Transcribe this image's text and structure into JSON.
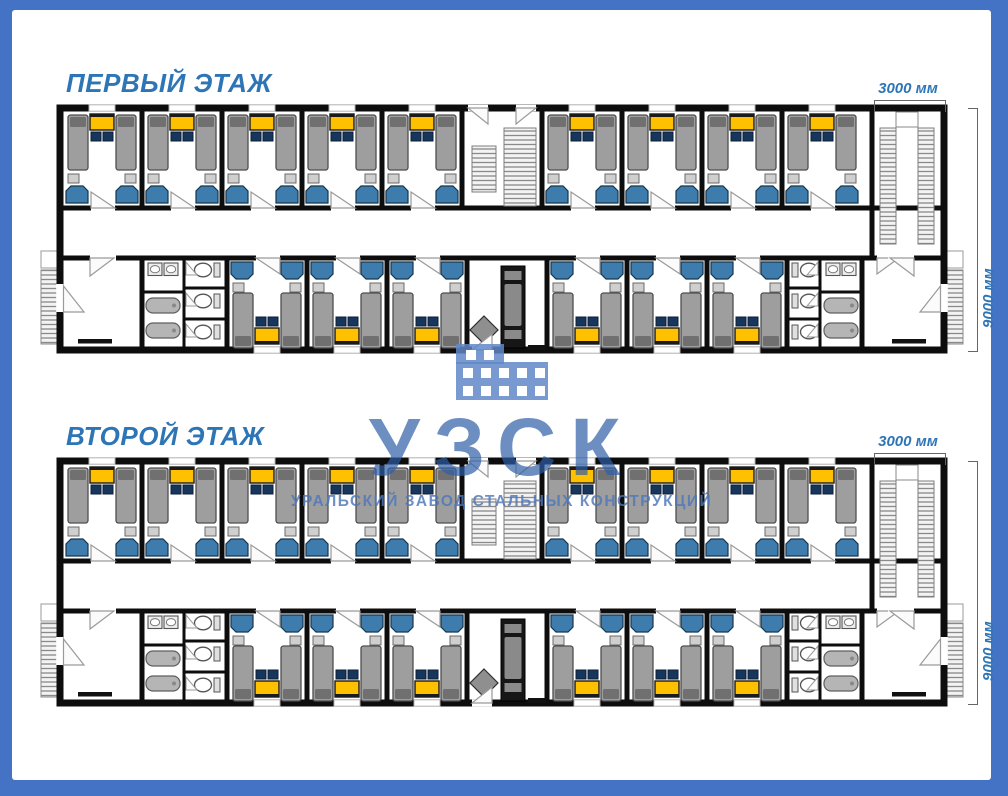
{
  "palette": {
    "frame_blue": "#4472C4",
    "title_blue": "#2E75B6",
    "wall": "#0d0d0d",
    "bed": "#9e9e9e",
    "bed_pillow": "#707070",
    "table": "#FFC000",
    "chair": "#17365D",
    "wardrobe": "#3F7CAE",
    "fixture_gray": "#b5b5b5",
    "door_gray": "#9a9a9a"
  },
  "watermark": {
    "logo_text": "УЗСК",
    "subtitle_text": "УРАЛЬСКИЙ ЗАВОД СТАЛЬНЫХ КОНСТРУКЦИЙ"
  },
  "floors": [
    {
      "title": "ПЕРВЫЙ ЭТАЖ",
      "dim_width_label": "3000 мм",
      "dim_height_label": "9000 мм"
    },
    {
      "title": "ВТОРОЙ ЭТАЖ",
      "dim_width_label": "3000 мм",
      "dim_height_label": "9000 мм"
    }
  ],
  "plan": {
    "rooms_top_left": 5,
    "rooms_top_right": 4,
    "rooms_bottom_left": 3,
    "rooms_bottom_right": 3,
    "room_furniture": [
      "bed",
      "bed",
      "table",
      "chair",
      "chair",
      "nightstand",
      "nightstand",
      "wardrobe",
      "wardrobe"
    ],
    "washrooms_per_floor": 2,
    "washroom": {
      "sinks": 2,
      "baths": 2,
      "wc_stalls": 3
    },
    "stairwells": [
      "central-entrance-stairs",
      "right-stairwell"
    ],
    "external_staircases": 2
  }
}
